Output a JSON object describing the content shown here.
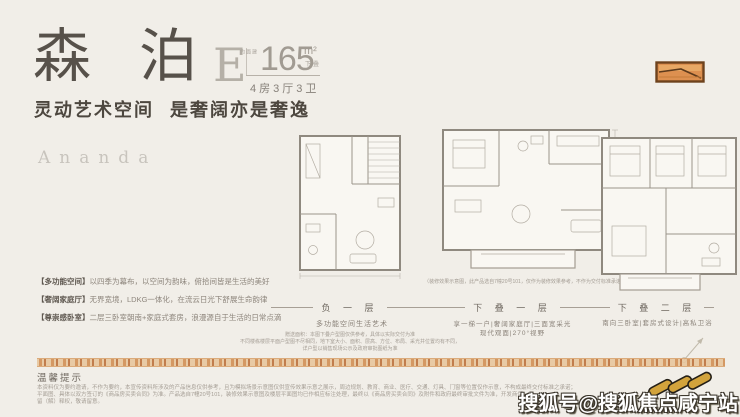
{
  "colors": {
    "background": "#f1eee8",
    "title_ink": "#57514a",
    "accent_orange": "#cf8a4c",
    "watermark_gold": "#d2a33c"
  },
  "header": {
    "title_chars": [
      "森",
      "泊"
    ],
    "type_letter": "E",
    "area_label_vertical": "建面约",
    "area_value": "165",
    "area_unit": "m²",
    "area_tag": "下叠",
    "room_spec": "4房3厅3卫",
    "slogan_part1": "灵动艺术空间",
    "slogan_part2": "是奢阔亦是奢逸"
  },
  "brand": {
    "name": "Ananda"
  },
  "features": [
    {
      "tag": "【多功能空间】",
      "text": "以四季为幕布，以空间为韵味，俯拾间皆是生活的美好"
    },
    {
      "tag": "【奢阔家庭厅】",
      "text": "无界宽境，LDKG一体化，在流云日光下舒展生命韵律"
    },
    {
      "tag": "【尊崇感卧室】",
      "text": "二层三卧室朝南+家庭式套房，浪漫源自于生活的日常点滴"
    }
  ],
  "plans": [
    {
      "name": "负 一 层",
      "subtitle": "多功能空间生活艺术",
      "notes": [
        "赠送面积：本图下叠户型图仅供参考，具体以实际交付为准",
        "不同楼栋楼层平面户型图不尽相同，地下室大小、面积、层高、方位、布局、采光井位置均有不同，",
        "详户型以销售现场公示及政府审批图纸为准"
      ]
    },
    {
      "name": "下 叠 一 层",
      "disclaimer": "（装修效果示意图，此产品选自7幢20号101，仅作为装修效果参考，不作为交付标准承诺）",
      "subtitle": "享一梯一户|奢阔家庭厅|三面宽采光",
      "subtitle2": "现代观面|270°视野"
    },
    {
      "name": "下 叠 二 层",
      "subtitle": "南向三卧室|套房式设计|高私卫浴"
    }
  ],
  "footer": {
    "tips_title": "温馨提示",
    "lines": [
      "本资料仅为要约邀请，不作为要约，本宣传资料所涉及的产品信息仅供参考，且为模拟场景示意图仅供宣传效果示意之展示，周边规划、教育、商业、医疗、交通、灯具、门窗等位置仅作示意，不构成最终交付标准之承诺；",
      "平面图、具体以双方签订的《商品房买卖合同》为准。产品选自7幢20号101，装修效果示意图及楼层平面图均已作相应标注处理，最终以《商品房买卖合同》及附件和政府最终审批文件为准，开发商保",
      "留（解）释权，敬请留意。"
    ]
  },
  "watermark": {
    "text": "搜狐号@搜狐焦点咸宁站"
  },
  "icons": {
    "brand_logo": "orange-seal-mark",
    "watermark_logo": "gold-diagonal-links",
    "compass": "north-arrow"
  }
}
